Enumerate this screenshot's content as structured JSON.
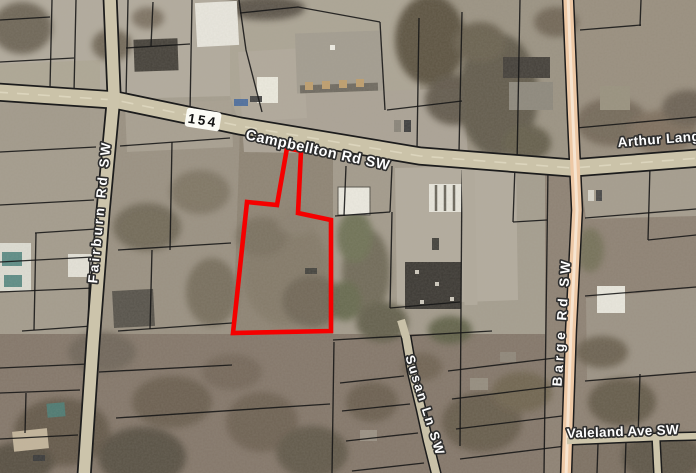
{
  "map": {
    "view": "aerial-parcel-map",
    "route_shield": {
      "number": "154"
    },
    "street_labels": [
      {
        "id": "campbellton",
        "text": "Campbellton Rd SW"
      },
      {
        "id": "arthur-langford",
        "text": "Arthur Lang"
      },
      {
        "id": "fairburn",
        "text": "Fairburn Rd SW"
      },
      {
        "id": "barge",
        "text": "Barge Rd SW"
      },
      {
        "id": "susan",
        "text": "Susan Ln SW"
      },
      {
        "id": "valeland",
        "text": "Valeland Ave SW"
      }
    ],
    "highlighted_parcel": {
      "outline_color": "#f50000"
    },
    "colors": {
      "label_fill": "#ffffff",
      "label_halo": "#2e2e2e",
      "parcel_line": "#161616",
      "road_fill": "#cbc3a9",
      "highway_fill": "#edc8a5",
      "shield_fill": "#fbfbf5"
    }
  }
}
